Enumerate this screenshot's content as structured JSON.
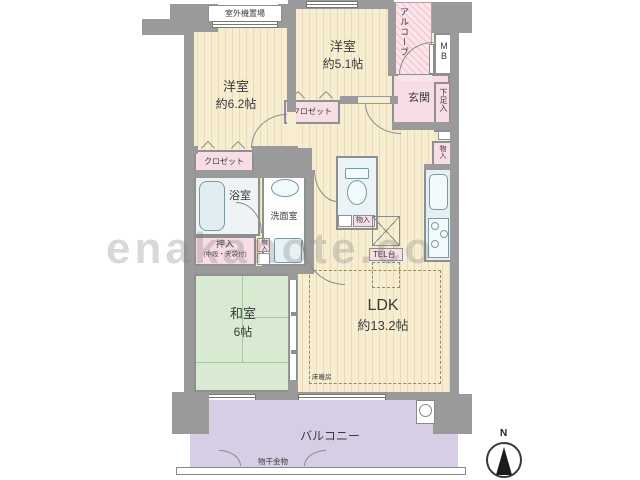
{
  "watermark": "enakanote.co",
  "compass": {
    "north_label": "N"
  },
  "labels": {
    "outdoor_unit": "室外機置場",
    "bedroom1_name": "洋室",
    "bedroom1_size": "約6.2帖",
    "bedroom2_name": "洋室",
    "bedroom2_size": "約5.1帖",
    "alcove": "アルコーブ",
    "meter_box": "MB",
    "entrance": "玄関",
    "shoe_storage": "下足入",
    "storage_hall": "物入",
    "closet_bedroom1": "クロゼット",
    "closet_bedroom2": "クロゼット",
    "bathroom": "浴室",
    "washroom": "洗面室",
    "oshiire_name": "押入",
    "oshiire_sub": "(中段・天袋付)",
    "storage_toilet": "物入",
    "storage_washroom": "物入",
    "tel_stand": "TEL台",
    "washitsu_name": "和室",
    "washitsu_size": "6帖",
    "ldk_name": "LDK",
    "ldk_size": "約13.2帖",
    "floor_heating": "床暖房",
    "balcony": "バルコニー",
    "laundry_fitting": "物干金物"
  },
  "colors": {
    "wall_gray": "#9a9a9a",
    "floor_cream": "#f7eed2",
    "room_pink": "#f8dde4",
    "tatami_green": "#d8ead2",
    "fixture_blue": "#e2eff3",
    "balcony_purple": "#d7cee5"
  }
}
